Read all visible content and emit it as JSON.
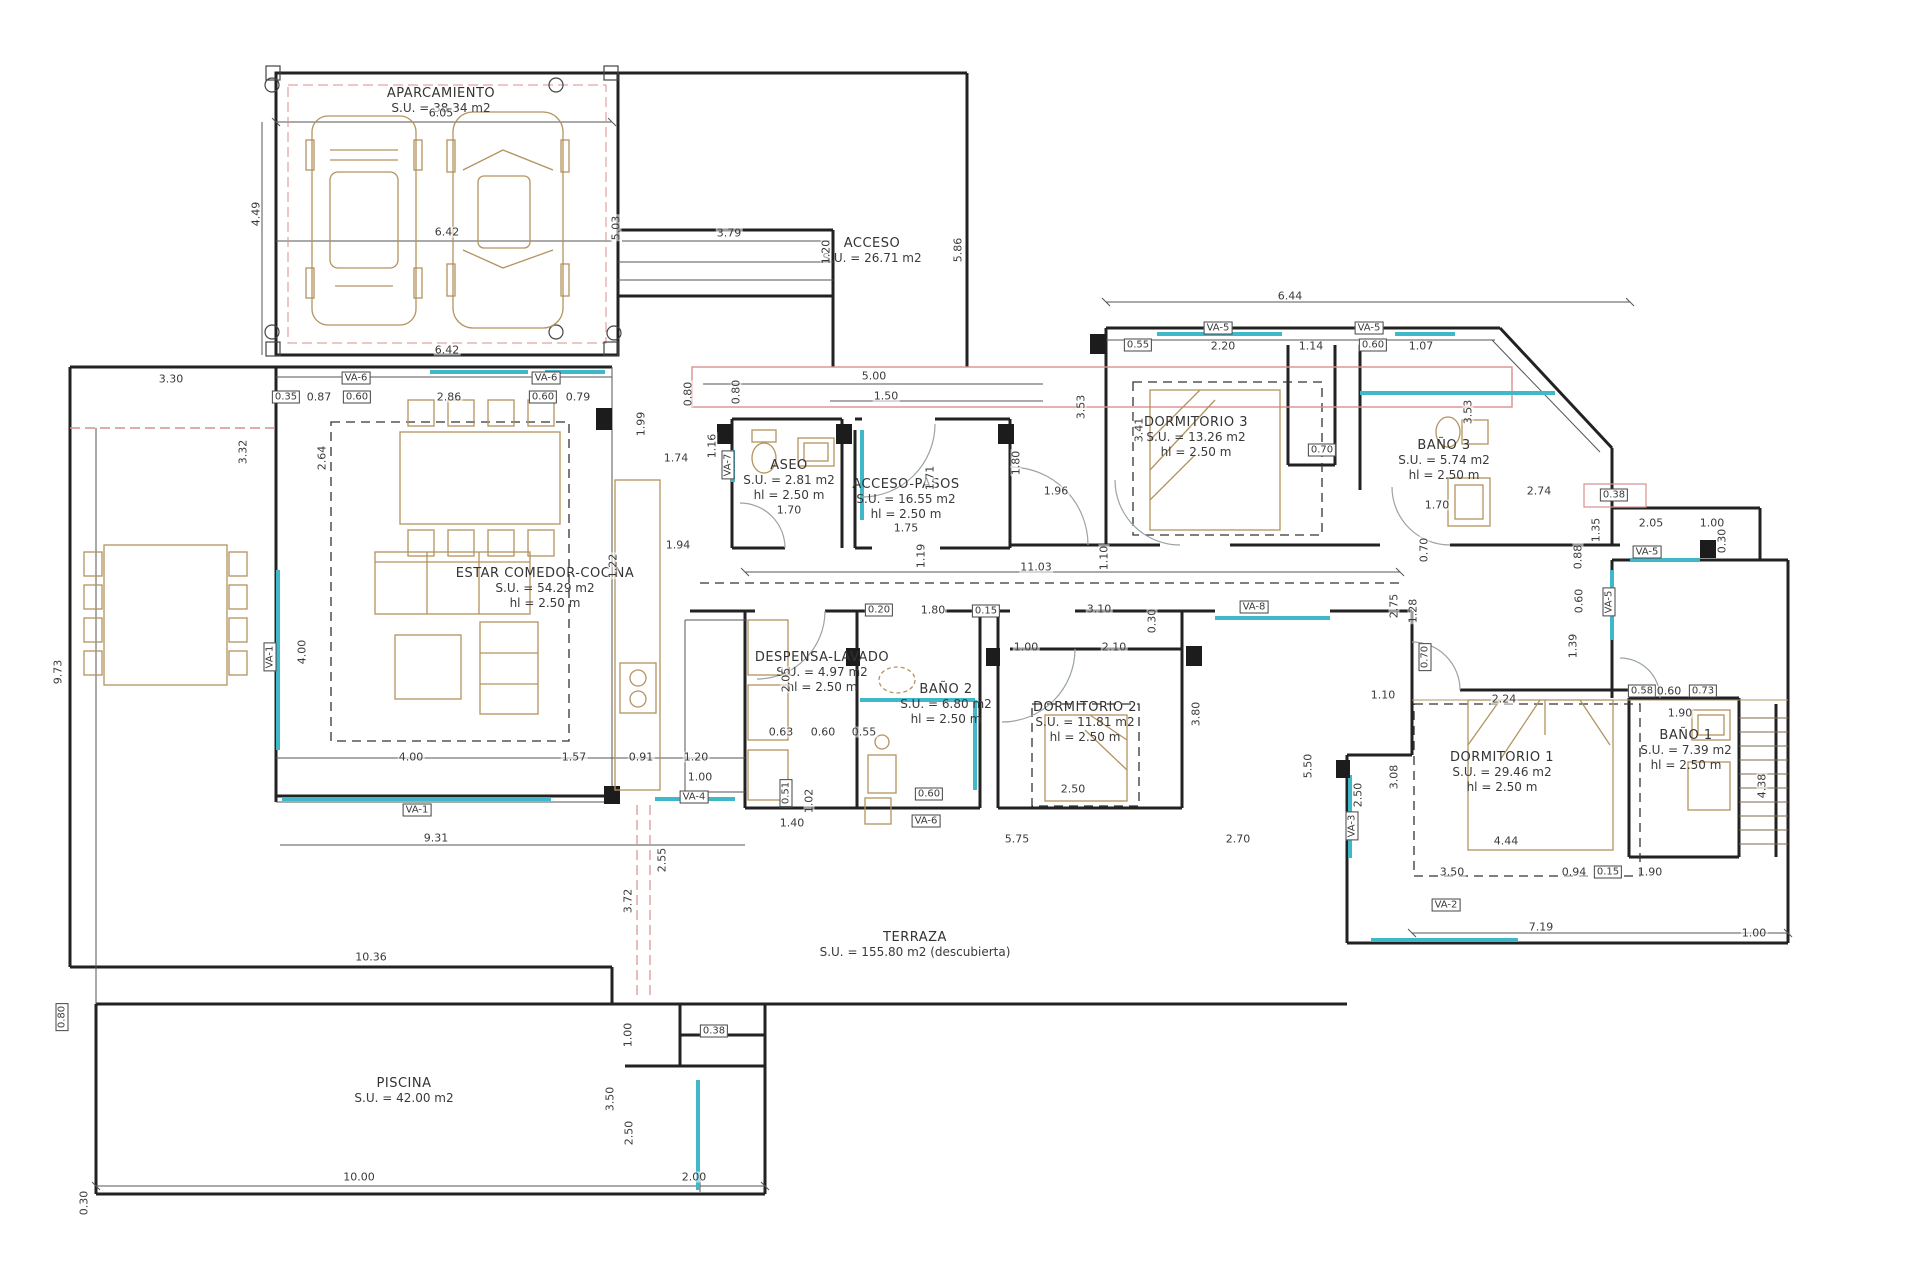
{
  "drawing_title": "Planta de vivienda unifamiliar",
  "colors": {
    "wall": "#222222",
    "thin": "#555555",
    "window_teal": "#3fb8c9",
    "furniture_tan": "#b3935f",
    "accent_red": "#d98f8f",
    "door_arc": "#9aa3a8",
    "dash_black": "#333333"
  },
  "rooms": [
    {
      "id": "aparcamiento",
      "x": 441,
      "y": 86,
      "lines": [
        "APARCAMIENTO",
        "S.U. = 38.34 m2"
      ]
    },
    {
      "id": "acceso",
      "x": 872,
      "y": 236,
      "lines": [
        "ACCESO",
        "S.U. = 26.71 m2"
      ]
    },
    {
      "id": "aseo",
      "x": 789,
      "y": 458,
      "lines": [
        "ASEO",
        "S.U. = 2.81 m2",
        "hl = 2.50 m"
      ]
    },
    {
      "id": "acceso-pasos",
      "x": 906,
      "y": 477,
      "lines": [
        "ACCESO-PASOS",
        "S.U. = 16.55 m2",
        "hl = 2.50 m"
      ]
    },
    {
      "id": "dormitorio-3",
      "x": 1196,
      "y": 415,
      "lines": [
        "DORMITORIO 3",
        "S.U. = 13.26 m2",
        "hl = 2.50 m"
      ]
    },
    {
      "id": "bano-3",
      "x": 1444,
      "y": 438,
      "lines": [
        "BAÑO 3",
        "S.U. = 5.74 m2",
        "hl = 2.50 m"
      ]
    },
    {
      "id": "estar-comedor-cocina",
      "x": 545,
      "y": 566,
      "lines": [
        "ESTAR COMEDOR-COCINA",
        "S.U. = 54.29 m2",
        "hl = 2.50 m"
      ]
    },
    {
      "id": "despensa-lavado",
      "x": 822,
      "y": 650,
      "lines": [
        "DESPENSA-LAVADO",
        "S.U. = 4.97 m2",
        "hl = 2.50 m"
      ]
    },
    {
      "id": "bano-2",
      "x": 946,
      "y": 682,
      "lines": [
        "BAÑO 2",
        "S.U. = 6.80 m2",
        "hl = 2.50 m"
      ]
    },
    {
      "id": "dormitorio-2",
      "x": 1085,
      "y": 700,
      "lines": [
        "DORMITORIO 2",
        "S.U. = 11.81 m2",
        "hl = 2.50 m"
      ]
    },
    {
      "id": "dormitorio-1",
      "x": 1502,
      "y": 750,
      "lines": [
        "DORMITORIO 1",
        "S.U. = 29.46 m2",
        "hl = 2.50 m"
      ]
    },
    {
      "id": "bano-1",
      "x": 1686,
      "y": 728,
      "lines": [
        "BAÑO 1",
        "S.U. = 7.39 m2",
        "hl = 2.50 m"
      ]
    },
    {
      "id": "terraza",
      "x": 915,
      "y": 930,
      "lines": [
        "TERRAZA",
        "S.U. = 155.80 m2 (descubierta)"
      ]
    },
    {
      "id": "piscina",
      "x": 404,
      "y": 1076,
      "lines": [
        "PISCINA",
        "S.U. = 42.00 m2"
      ]
    }
  ],
  "dimensions": [
    {
      "v": "6.05",
      "x": 441,
      "y": 113
    },
    {
      "v": "4.49",
      "x": 256,
      "y": 214,
      "r": true
    },
    {
      "v": "6.42",
      "x": 447,
      "y": 232
    },
    {
      "v": "5.03",
      "x": 616,
      "y": 228,
      "r": true
    },
    {
      "v": "6.42",
      "x": 447,
      "y": 350
    },
    {
      "v": "3.79",
      "x": 729,
      "y": 233
    },
    {
      "v": "1.20",
      "x": 826,
      "y": 252,
      "r": true
    },
    {
      "v": "5.86",
      "x": 958,
      "y": 250,
      "r": true
    },
    {
      "v": "5.00",
      "x": 874,
      "y": 376
    },
    {
      "v": "1.50",
      "x": 886,
      "y": 396
    },
    {
      "v": "0.80",
      "x": 688,
      "y": 394,
      "r": true
    },
    {
      "v": "3.30",
      "x": 171,
      "y": 379
    },
    {
      "v": "0.35",
      "x": 286,
      "y": 397,
      "b": true
    },
    {
      "v": "0.87",
      "x": 319,
      "y": 397
    },
    {
      "v": "0.60",
      "x": 357,
      "y": 397,
      "b": true
    },
    {
      "v": "2.86",
      "x": 449,
      "y": 397
    },
    {
      "v": "0.60",
      "x": 543,
      "y": 397,
      "b": true
    },
    {
      "v": "0.79",
      "x": 578,
      "y": 397
    },
    {
      "v": "VA-6",
      "x": 356,
      "y": 378,
      "b": true
    },
    {
      "v": "VA-6",
      "x": 546,
      "y": 378,
      "b": true
    },
    {
      "v": "3.32",
      "x": 243,
      "y": 452,
      "r": true
    },
    {
      "v": "2.64",
      "x": 322,
      "y": 458,
      "r": true
    },
    {
      "v": "9.73",
      "x": 58,
      "y": 672,
      "r": true
    },
    {
      "v": "VA-1",
      "x": 270,
      "y": 657,
      "r": true,
      "b": true
    },
    {
      "v": "4.00",
      "x": 302,
      "y": 652,
      "r": true
    },
    {
      "v": "4.00",
      "x": 411,
      "y": 757
    },
    {
      "v": "1.57",
      "x": 574,
      "y": 757
    },
    {
      "v": "0.91",
      "x": 641,
      "y": 757
    },
    {
      "v": "1.20",
      "x": 696,
      "y": 757
    },
    {
      "v": "1.00",
      "x": 700,
      "y": 777
    },
    {
      "v": "VA-4",
      "x": 694,
      "y": 797,
      "b": true
    },
    {
      "v": "VA-1",
      "x": 417,
      "y": 810,
      "b": true
    },
    {
      "v": "9.31",
      "x": 436,
      "y": 838
    },
    {
      "v": "1.94",
      "x": 678,
      "y": 545
    },
    {
      "v": "1.22",
      "x": 613,
      "y": 566,
      "r": true
    },
    {
      "v": "1.74",
      "x": 676,
      "y": 458
    },
    {
      "v": "1.16",
      "x": 712,
      "y": 446,
      "r": true
    },
    {
      "v": "1.99",
      "x": 641,
      "y": 424,
      "r": true
    },
    {
      "v": "0.80",
      "x": 736,
      "y": 392,
      "r": true
    },
    {
      "v": "VA-7",
      "x": 728,
      "y": 465,
      "r": true,
      "b": true
    },
    {
      "v": "1.70",
      "x": 789,
      "y": 510
    },
    {
      "v": "1.75",
      "x": 906,
      "y": 528
    },
    {
      "v": "1.71",
      "x": 930,
      "y": 478,
      "r": true
    },
    {
      "v": "2.05",
      "x": 786,
      "y": 680,
      "r": true
    },
    {
      "v": "11.03",
      "x": 1036,
      "y": 567
    },
    {
      "v": "1.19",
      "x": 921,
      "y": 556,
      "r": true
    },
    {
      "v": "1.10",
      "x": 1104,
      "y": 558,
      "r": true
    },
    {
      "v": "1.80",
      "x": 1016,
      "y": 463,
      "r": true
    },
    {
      "v": "1.96",
      "x": 1056,
      "y": 491
    },
    {
      "v": "6.44",
      "x": 1290,
      "y": 296
    },
    {
      "v": "VA-5",
      "x": 1218,
      "y": 328,
      "b": true
    },
    {
      "v": "0.55",
      "x": 1138,
      "y": 345,
      "b": true
    },
    {
      "v": "2.20",
      "x": 1223,
      "y": 346
    },
    {
      "v": "1.14",
      "x": 1311,
      "y": 346
    },
    {
      "v": "VA-5",
      "x": 1369,
      "y": 328,
      "b": true
    },
    {
      "v": "0.60",
      "x": 1373,
      "y": 345,
      "b": true
    },
    {
      "v": "1.07",
      "x": 1421,
      "y": 346
    },
    {
      "v": "3.53",
      "x": 1081,
      "y": 407,
      "r": true
    },
    {
      "v": "3.41",
      "x": 1139,
      "y": 430,
      "r": true
    },
    {
      "v": "0.70",
      "x": 1322,
      "y": 450,
      "b": true
    },
    {
      "v": "3.53",
      "x": 1468,
      "y": 412,
      "r": true
    },
    {
      "v": "2.74",
      "x": 1539,
      "y": 491
    },
    {
      "v": "1.70",
      "x": 1437,
      "y": 505
    },
    {
      "v": "0.38",
      "x": 1614,
      "y": 495,
      "b": true
    },
    {
      "v": "1.35",
      "x": 1596,
      "y": 530,
      "r": true
    },
    {
      "v": "2.05",
      "x": 1651,
      "y": 523
    },
    {
      "v": "1.00",
      "x": 1712,
      "y": 523
    },
    {
      "v": "0.30",
      "x": 1722,
      "y": 541,
      "r": true
    },
    {
      "v": "VA-5",
      "x": 1647,
      "y": 552,
      "b": true
    },
    {
      "v": "0.88",
      "x": 1578,
      "y": 557,
      "r": true
    },
    {
      "v": "0.60",
      "x": 1579,
      "y": 601,
      "r": true
    },
    {
      "v": "1.39",
      "x": 1573,
      "y": 646,
      "r": true
    },
    {
      "v": "VA-5",
      "x": 1609,
      "y": 602,
      "r": true,
      "b": true
    },
    {
      "v": "2.75",
      "x": 1394,
      "y": 606,
      "r": true
    },
    {
      "v": "1.28",
      "x": 1413,
      "y": 611,
      "r": true
    },
    {
      "v": "0.70",
      "x": 1424,
      "y": 550,
      "r": true
    },
    {
      "v": "0.70",
      "x": 1425,
      "y": 657,
      "r": true,
      "b": true
    },
    {
      "v": "1.10",
      "x": 1383,
      "y": 695
    },
    {
      "v": "2.24",
      "x": 1504,
      "y": 699
    },
    {
      "v": "3.10",
      "x": 1099,
      "y": 609
    },
    {
      "v": "0.30",
      "x": 1152,
      "y": 621,
      "r": true
    },
    {
      "v": "2.10",
      "x": 1114,
      "y": 647
    },
    {
      "v": "1.00",
      "x": 1026,
      "y": 647
    },
    {
      "v": "0.20",
      "x": 879,
      "y": 610,
      "b": true
    },
    {
      "v": "1.80",
      "x": 933,
      "y": 610
    },
    {
      "v": "0.15",
      "x": 986,
      "y": 611,
      "b": true
    },
    {
      "v": "0.60",
      "x": 929,
      "y": 794,
      "b": true
    },
    {
      "v": "VA-6",
      "x": 926,
      "y": 821,
      "b": true
    },
    {
      "v": "0.63",
      "x": 781,
      "y": 732
    },
    {
      "v": "0.60",
      "x": 823,
      "y": 732
    },
    {
      "v": "0.55",
      "x": 864,
      "y": 732
    },
    {
      "v": "0.51",
      "x": 786,
      "y": 793,
      "r": true,
      "b": true
    },
    {
      "v": "1.02",
      "x": 809,
      "y": 801,
      "r": true
    },
    {
      "v": "1.40",
      "x": 792,
      "y": 823
    },
    {
      "v": "2.50",
      "x": 1073,
      "y": 789
    },
    {
      "v": "5.75",
      "x": 1017,
      "y": 839
    },
    {
      "v": "2.70",
      "x": 1238,
      "y": 839
    },
    {
      "v": "3.80",
      "x": 1196,
      "y": 714,
      "r": true
    },
    {
      "v": "5.50",
      "x": 1308,
      "y": 766,
      "r": true
    },
    {
      "v": "VA-8",
      "x": 1254,
      "y": 607,
      "b": true
    },
    {
      "v": "4.44",
      "x": 1506,
      "y": 841
    },
    {
      "v": "3.50",
      "x": 1452,
      "y": 872
    },
    {
      "v": "0.94",
      "x": 1574,
      "y": 872
    },
    {
      "v": "0.15",
      "x": 1608,
      "y": 872,
      "b": true
    },
    {
      "v": "1.90",
      "x": 1650,
      "y": 872
    },
    {
      "v": "7.19",
      "x": 1541,
      "y": 927
    },
    {
      "v": "1.00",
      "x": 1754,
      "y": 933
    },
    {
      "v": "VA-2",
      "x": 1446,
      "y": 905,
      "b": true
    },
    {
      "v": "2.50",
      "x": 1358,
      "y": 795,
      "r": true
    },
    {
      "v": "3.08",
      "x": 1394,
      "y": 777,
      "r": true
    },
    {
      "v": "VA-3",
      "x": 1352,
      "y": 826,
      "r": true,
      "b": true
    },
    {
      "v": "4.38",
      "x": 1762,
      "y": 786,
      "r": true
    },
    {
      "v": "0.58",
      "x": 1642,
      "y": 691,
      "b": true
    },
    {
      "v": "0.60",
      "x": 1669,
      "y": 691
    },
    {
      "v": "0.73",
      "x": 1703,
      "y": 691,
      "b": true
    },
    {
      "v": "1.90",
      "x": 1680,
      "y": 713
    },
    {
      "v": "10.36",
      "x": 371,
      "y": 957
    },
    {
      "v": "2.55",
      "x": 662,
      "y": 860,
      "r": true
    },
    {
      "v": "3.72",
      "x": 628,
      "y": 901,
      "r": true
    },
    {
      "v": "0.80",
      "x": 62,
      "y": 1017,
      "r": true,
      "b": true
    },
    {
      "v": "0.30",
      "x": 84,
      "y": 1203,
      "r": true
    },
    {
      "v": "10.00",
      "x": 359,
      "y": 1177
    },
    {
      "v": "2.00",
      "x": 694,
      "y": 1177
    },
    {
      "v": "3.50",
      "x": 610,
      "y": 1099,
      "r": true
    },
    {
      "v": "2.50",
      "x": 629,
      "y": 1133,
      "r": true
    },
    {
      "v": "1.00",
      "x": 628,
      "y": 1035,
      "r": true
    },
    {
      "v": "0.38",
      "x": 714,
      "y": 1031,
      "b": true
    }
  ]
}
